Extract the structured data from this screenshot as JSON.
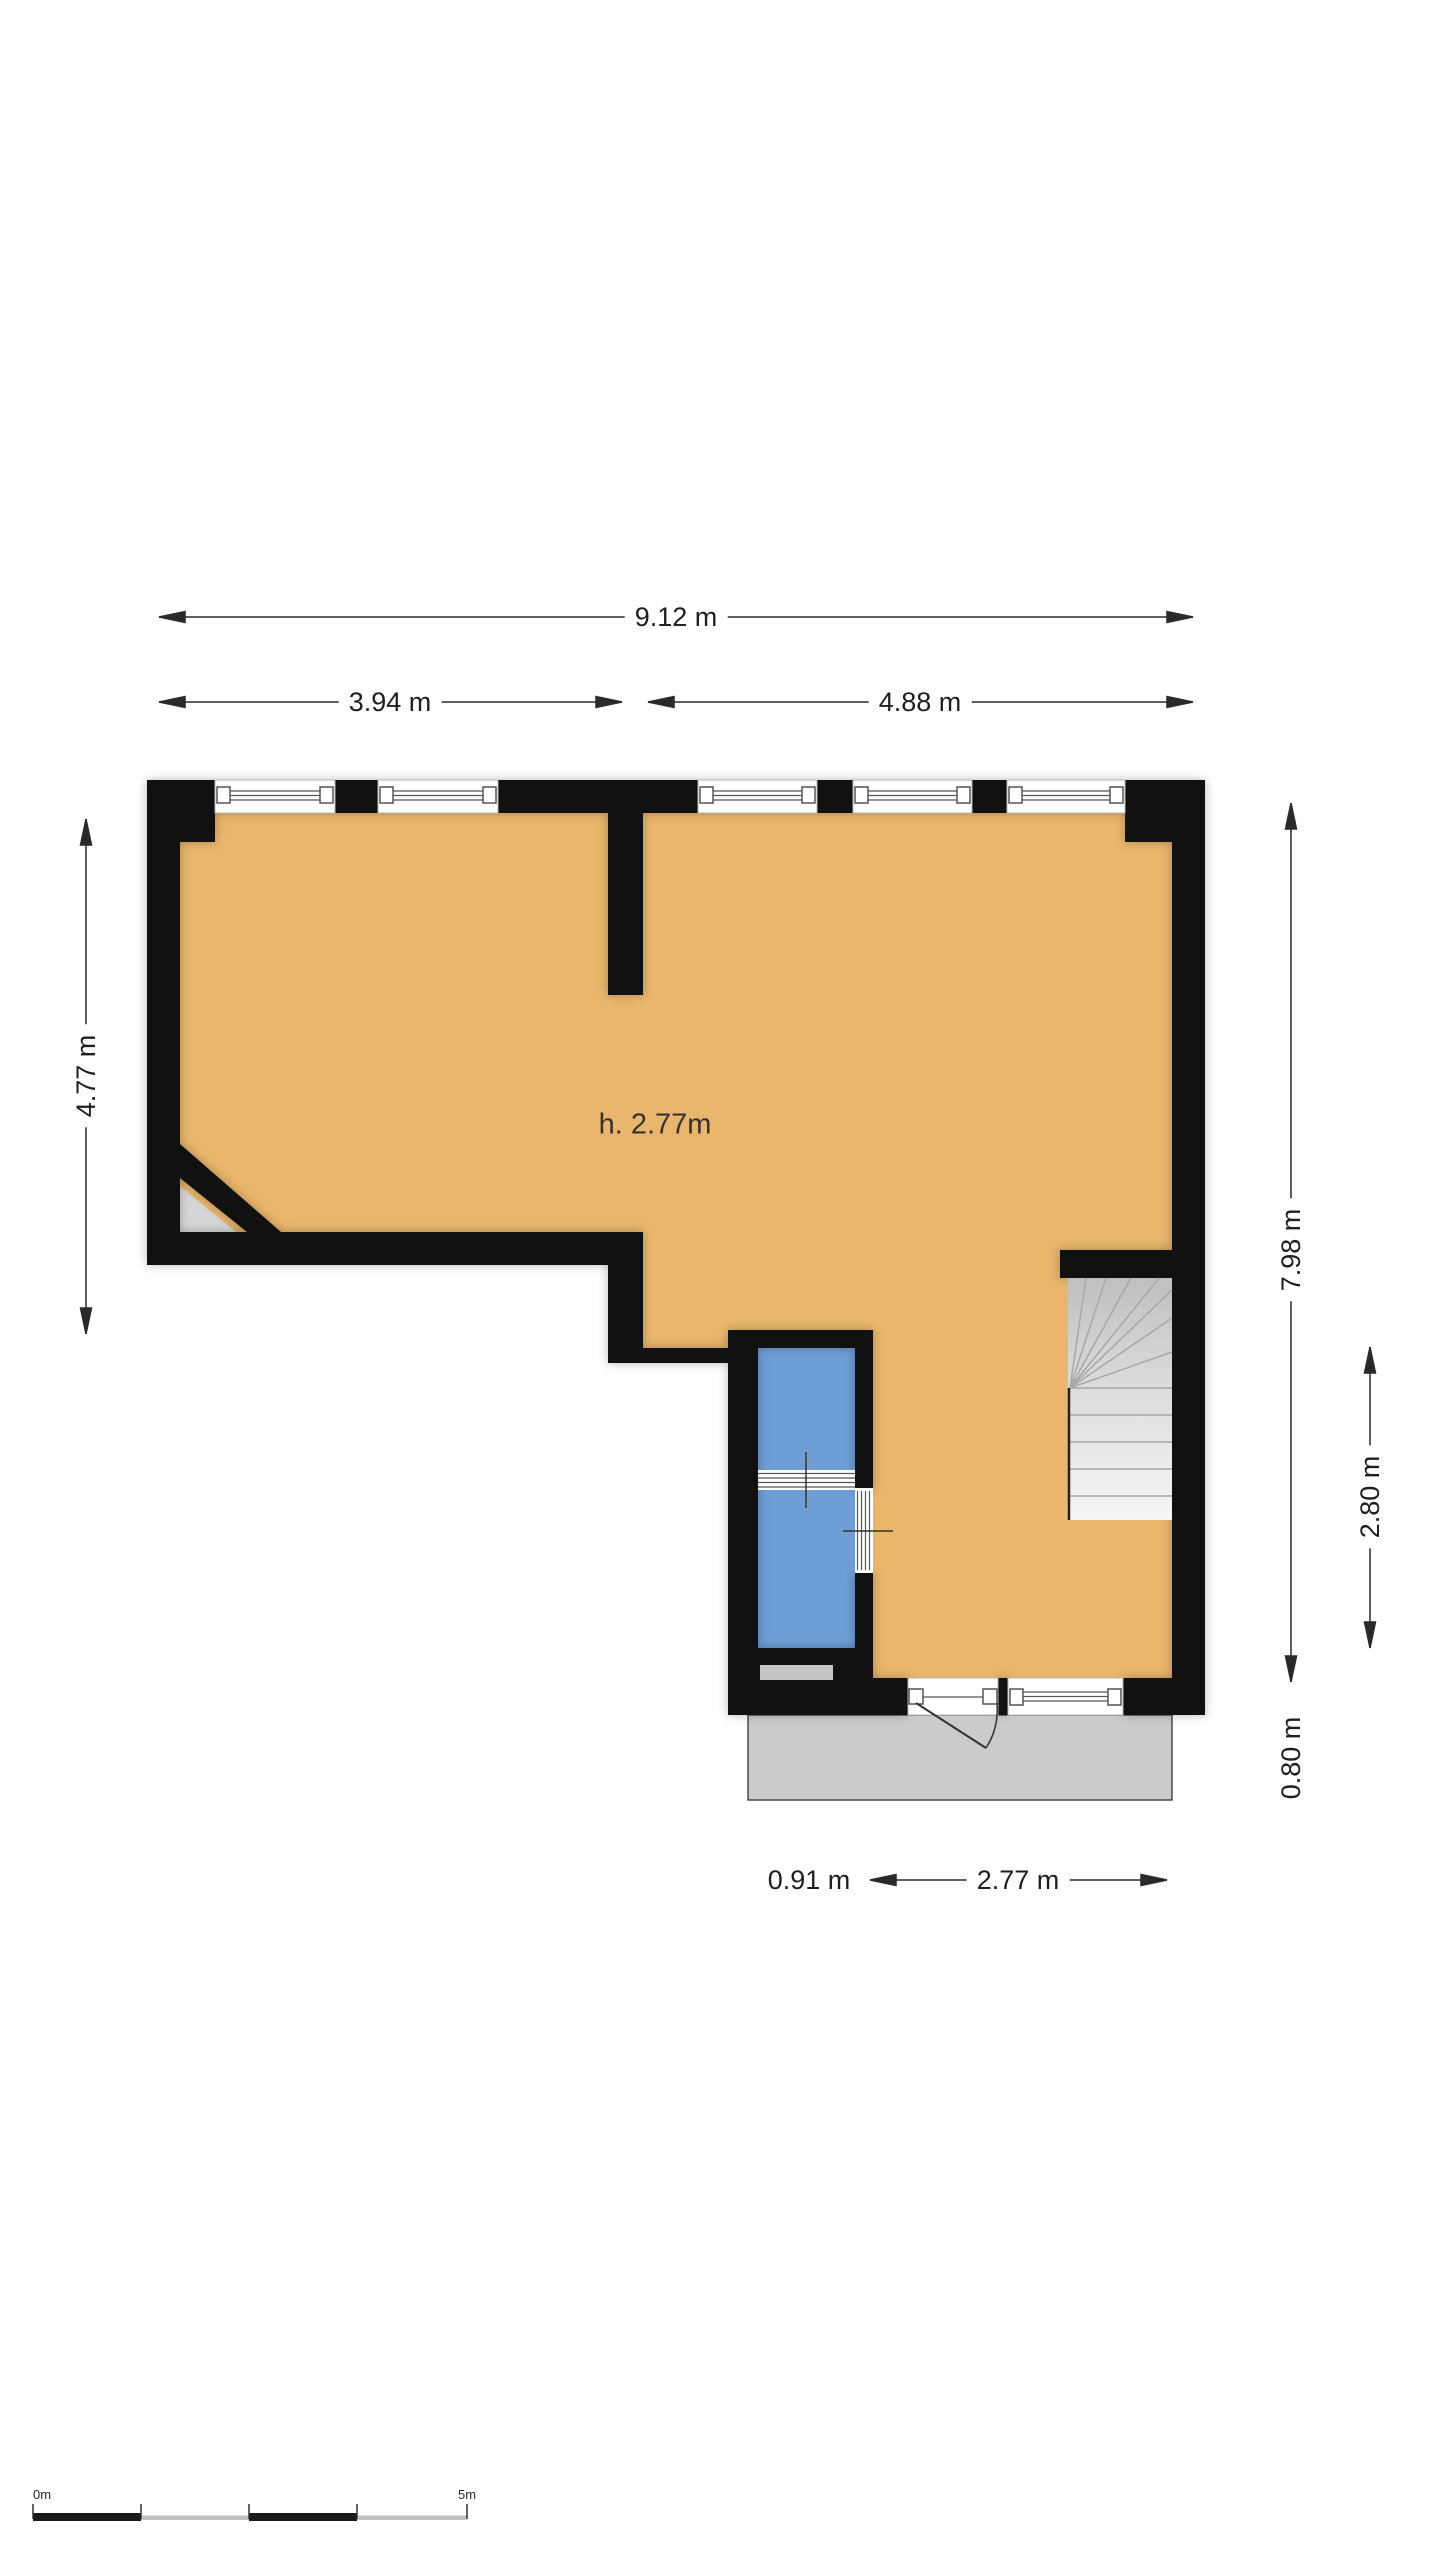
{
  "plan": {
    "ceiling_height_label": "h. 2.77m",
    "dimensions": {
      "total_width": "9.12 m",
      "left_width": "3.94 m",
      "right_width": "4.88 m",
      "left_height": "4.77 m",
      "right_height": "7.98 m",
      "stair_well_depth": "2.80 m",
      "balcony_depth": "0.80 m",
      "bath_width": "0.91 m",
      "hall_width": "2.77 m"
    },
    "scale_bar": {
      "start_label": "0m",
      "end_label": "5m"
    },
    "colors": {
      "floor": "#e9b66b",
      "wet_room": "#6e9ed6",
      "wall": "#111111",
      "balcony": "#cbcbcb",
      "stair_light": "#f6f6f6",
      "stair_dark": "#bfbfbf",
      "dimension_line": "#2a2a2a"
    }
  }
}
